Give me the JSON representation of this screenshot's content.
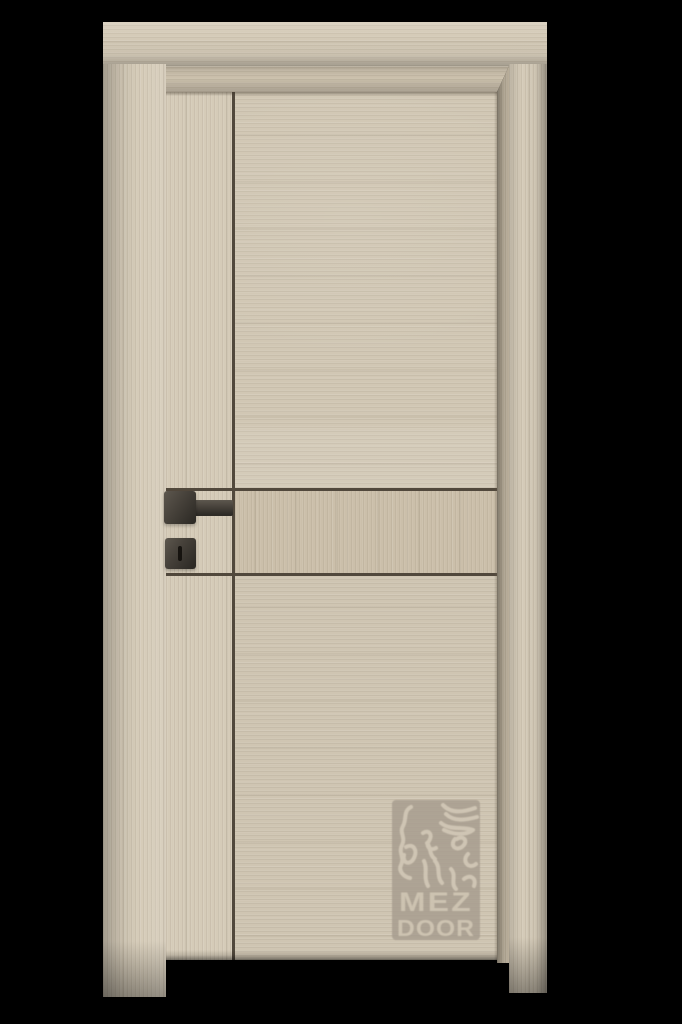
{
  "colors": {
    "background": "#000000",
    "casing": "#d5cbb8",
    "reveal": "#cbc0ac",
    "jamb_shadow": "#b9ae9a",
    "leaf": "#d1c7b4",
    "stile": "#d5cbb8",
    "band": "#cbbfaa",
    "panel_lower": "#cfc5b2",
    "groove": "#51483c",
    "hardware_dark": "#2e2b26",
    "hardware_mid": "#46413a",
    "hardware_light": "#5d574e",
    "logo_plate": "#a69c8e",
    "logo_line": "#d2c8b6",
    "logo_text": "#cdc3b1"
  },
  "door": {
    "finish_tone": "light oak beige",
    "groove_layout": "one vertical groove and two horizontal grooves forming a middle band",
    "hardware_style": "square black lever handle with separate square keyhole escutcheon"
  },
  "logo": {
    "line1": "MEZ",
    "line2": "DOOR",
    "pattern": "wood-grain-topographic-emblem"
  }
}
